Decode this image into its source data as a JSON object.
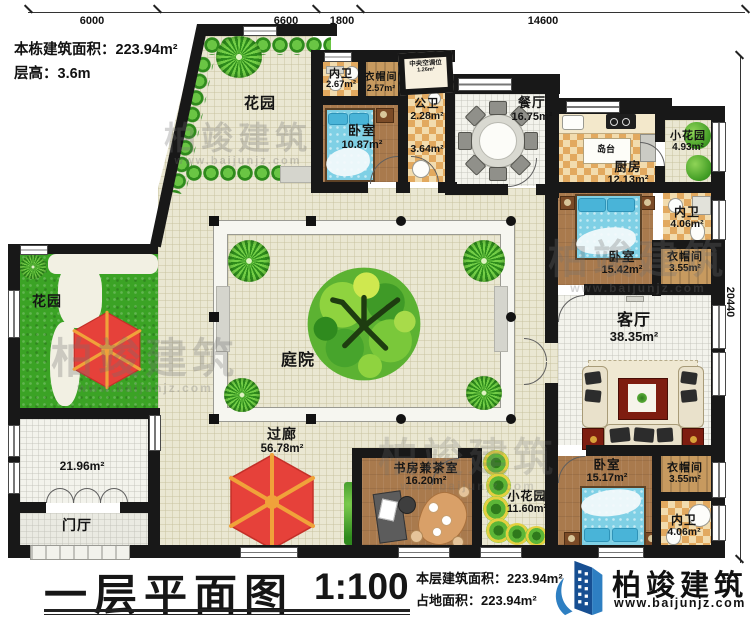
{
  "info": {
    "line1": "本栋建筑面积：223.94m²",
    "line2": "层高：3.6m"
  },
  "dimensions": {
    "top": [
      "6000",
      "6600",
      "1800",
      "14600"
    ],
    "right": "20440"
  },
  "rooms": {
    "garden_tl": {
      "name": "花园"
    },
    "bath_top": {
      "name": "内卫",
      "area": "2.67m²"
    },
    "cloak_top": {
      "name": "衣帽间",
      "area": "2.57m²"
    },
    "bed_top": {
      "name": "卧室",
      "area": "10.87m²"
    },
    "ac": {
      "name": "中央空调位",
      "area": "1.26m²"
    },
    "pubbath": {
      "name": "公卫",
      "area": "2.28m²"
    },
    "hall364": {
      "area": "3.64m²"
    },
    "dining": {
      "name": "餐厅",
      "area": "16.75m²"
    },
    "island": {
      "name": "岛台"
    },
    "kitchen": {
      "name": "厨房",
      "area": "12.13m²"
    },
    "smallgarden_tr": {
      "name": "小花园",
      "area": "4.93m²"
    },
    "bath_tr": {
      "name": "内卫",
      "area": "4.06m²"
    },
    "bed_right": {
      "name": "卧室",
      "area": "15.42m²"
    },
    "cloak_right": {
      "name": "衣帽间",
      "area": "3.55m²"
    },
    "living": {
      "name": "客厅",
      "area": "38.35m²"
    },
    "bed_br": {
      "name": "卧室",
      "area": "15.17m²"
    },
    "cloak_br": {
      "name": "衣帽间",
      "area": "3.55m²"
    },
    "bath_br": {
      "name": "内卫",
      "area": "4.06m²"
    },
    "study": {
      "name": "书房兼茶室",
      "area": "16.20m²"
    },
    "smallgarden_b": {
      "name": "小花园",
      "area": "11.60m²"
    },
    "courtyard": {
      "name": "庭院"
    },
    "corridor": {
      "name": "过廊",
      "area": "56.78m²"
    },
    "garden_left": {
      "name": "花园"
    },
    "room2196": {
      "area": "21.96m²"
    },
    "foyer": {
      "name": "门厅"
    }
  },
  "title_block": {
    "title": "一层平面图",
    "scale": "1:100",
    "floor_area": "本层建筑面积：223.94m²",
    "land_area": "占地面积：223.94m²"
  },
  "logo": {
    "name": "柏竣建筑",
    "url": "www.baijunjz.com"
  },
  "watermark": {
    "name": "柏竣建筑",
    "url": "www.baijunjz.com"
  }
}
